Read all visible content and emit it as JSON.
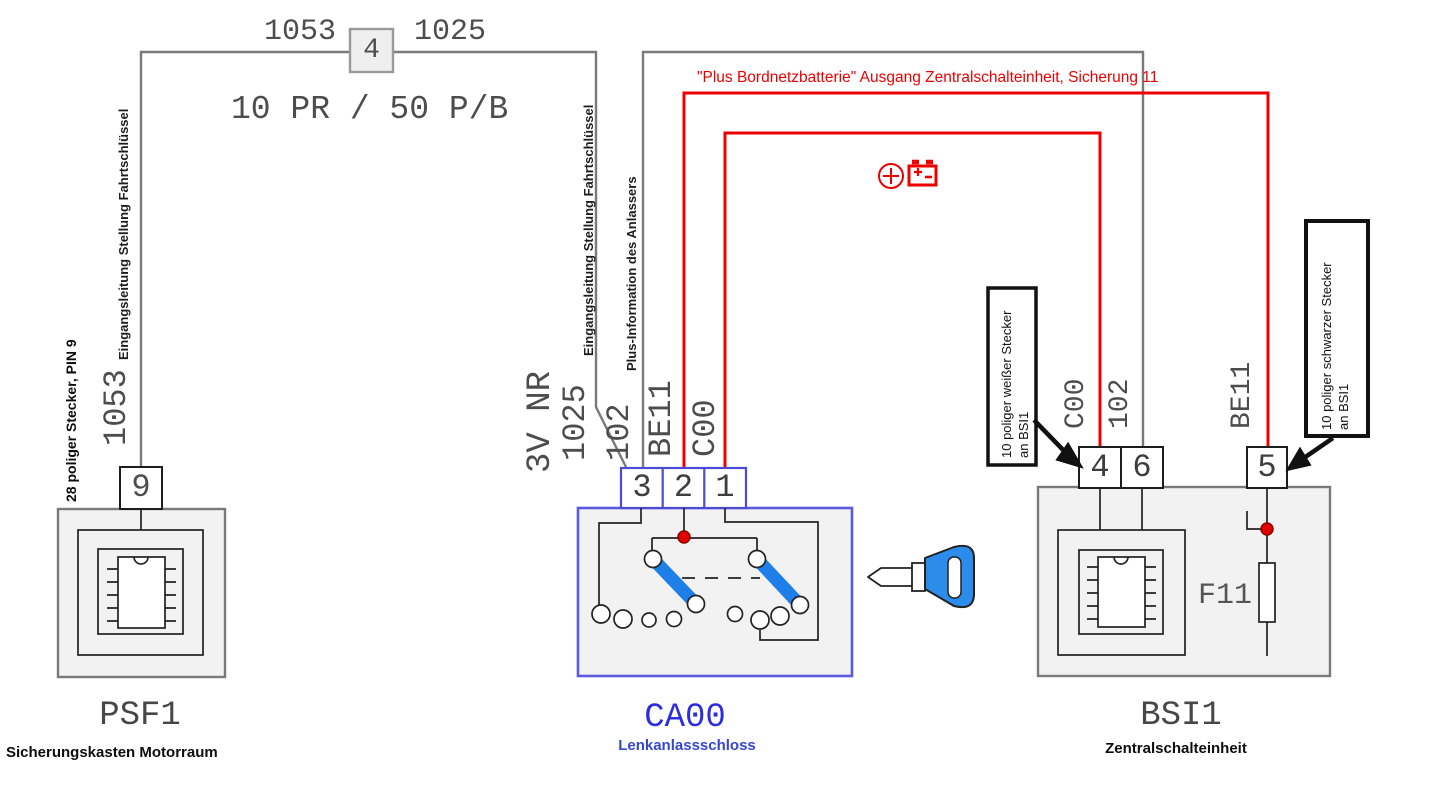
{
  "top": {
    "label_1053": "1053",
    "splice": "4",
    "label_1025": "1025",
    "wire_spec": "10 PR / 50 P/B"
  },
  "power_note": "\"Plus Bordnetzbatterie\" Ausgang Zentralschalteinheit, Sicherung 11",
  "psf1": {
    "connector_note": "28 poliger Stecker, PIN 9",
    "wire_number": "1053",
    "wire_function": "Eingangsleitung Stellung Fahrtschlüssel",
    "pin": "9",
    "code": "PSF1",
    "name": "Sicherungskasten Motorraum"
  },
  "ca00": {
    "position_label": "3V NR",
    "wire_1025": {
      "number": "1025",
      "function": "Eingangsleitung Stellung Fahrtschlüssel"
    },
    "wire_102": {
      "number": "102",
      "function": "Plus-Information des Anlassers"
    },
    "wire_be11": "BE11",
    "wire_c00": "C00",
    "pins": [
      "3",
      "2",
      "1"
    ],
    "code": "CA00",
    "name": "Lenkanlassschloss"
  },
  "bsi1": {
    "wire_c00": "C00",
    "wire_102": "102",
    "wire_be11": "BE11",
    "pins": [
      "4",
      "6",
      "5"
    ],
    "fuse": "F11",
    "code": "BSI1",
    "name": "Zentralschalteinheit"
  },
  "callouts": {
    "white": {
      "line1": "10 poliger weißer Stecker",
      "line2": "an BSI1"
    },
    "black": {
      "line1": "10 poliger schwarzer Stecker",
      "line2": "an BSI1"
    }
  },
  "colors": {
    "wire_red": "#ee0000",
    "wire_gray": "#7a7a7a",
    "component_fill": "#f2f2f2",
    "ca00_border_blue": "#5a5ae0",
    "switch_blue": "#1f7fe8",
    "key_blue": "#2b8ceb"
  }
}
